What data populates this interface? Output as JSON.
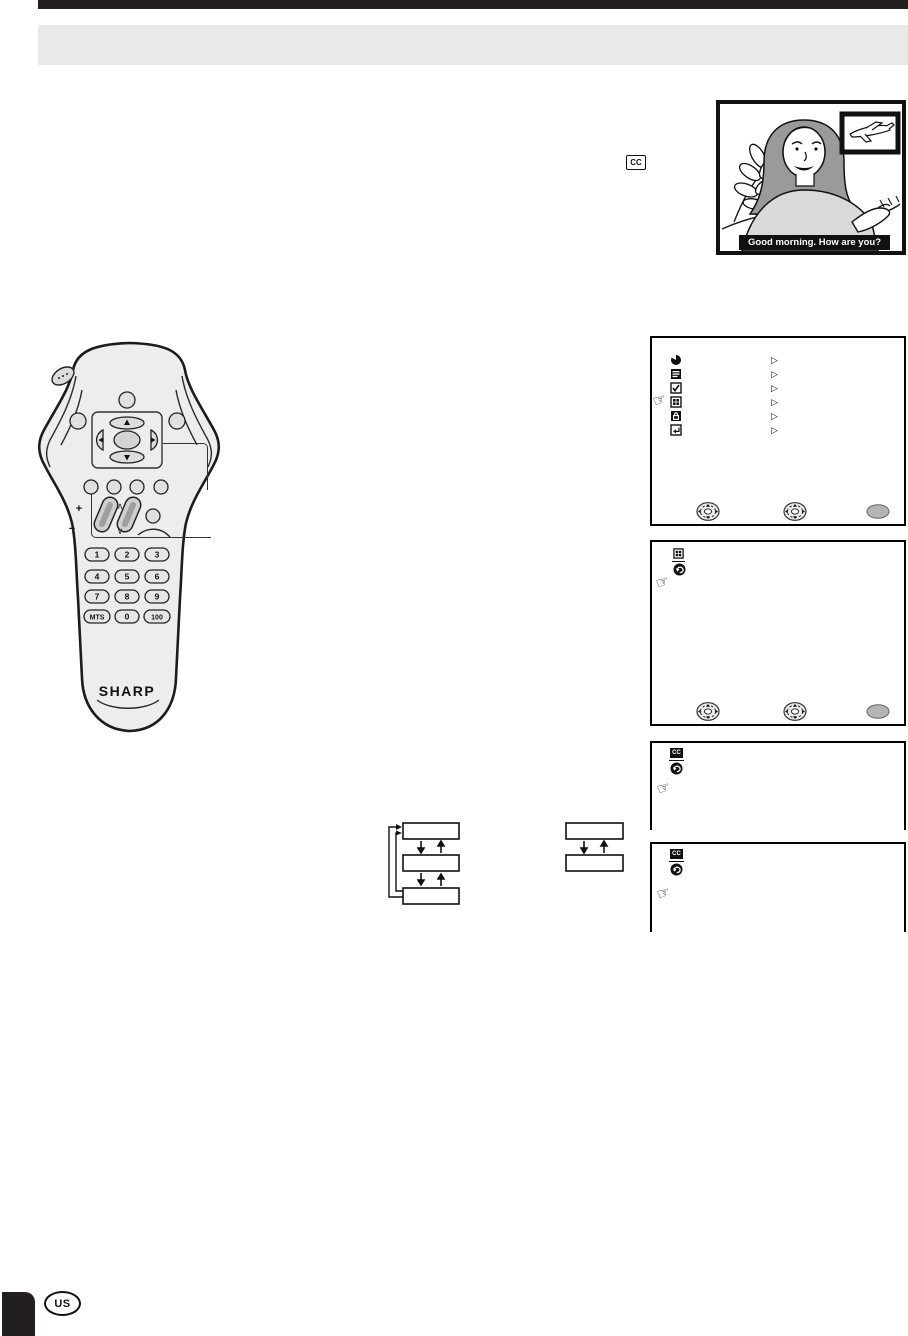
{
  "badges": {
    "closed_caption": "CC",
    "region": "US"
  },
  "caption_demo": {
    "caption_text": "Good morning. How are you?"
  },
  "remote": {
    "brand": "SHARP",
    "volume_plus": "+",
    "volume_minus": "−",
    "rocker_up_mark": "∧",
    "rocker_down_mark": "∨",
    "keys": [
      "1",
      "2",
      "3",
      "4",
      "5",
      "6",
      "7",
      "8",
      "9",
      "MTS",
      "0",
      "100"
    ]
  },
  "menu_screens": {
    "main": {
      "items": [
        "picture",
        "audio",
        "setup",
        "feature",
        "parental-lock",
        "exit"
      ],
      "selected_item": "feature",
      "item_cursor": "▷",
      "footer_icons": [
        "dpad",
        "dpad",
        "enter"
      ]
    },
    "feature": {
      "header_icons": [
        "feature",
        "return"
      ],
      "footer_icons": [
        "dpad",
        "dpad",
        "enter"
      ]
    },
    "caption_screen_1": {
      "header_icons": [
        "closed-caption",
        "return"
      ]
    },
    "caption_screen_2": {
      "header_icons": [
        "closed-caption",
        "return"
      ]
    }
  },
  "flow_diagram": {
    "left_boxes": [
      "",
      "",
      ""
    ],
    "right_boxes": [
      "",
      ""
    ]
  }
}
